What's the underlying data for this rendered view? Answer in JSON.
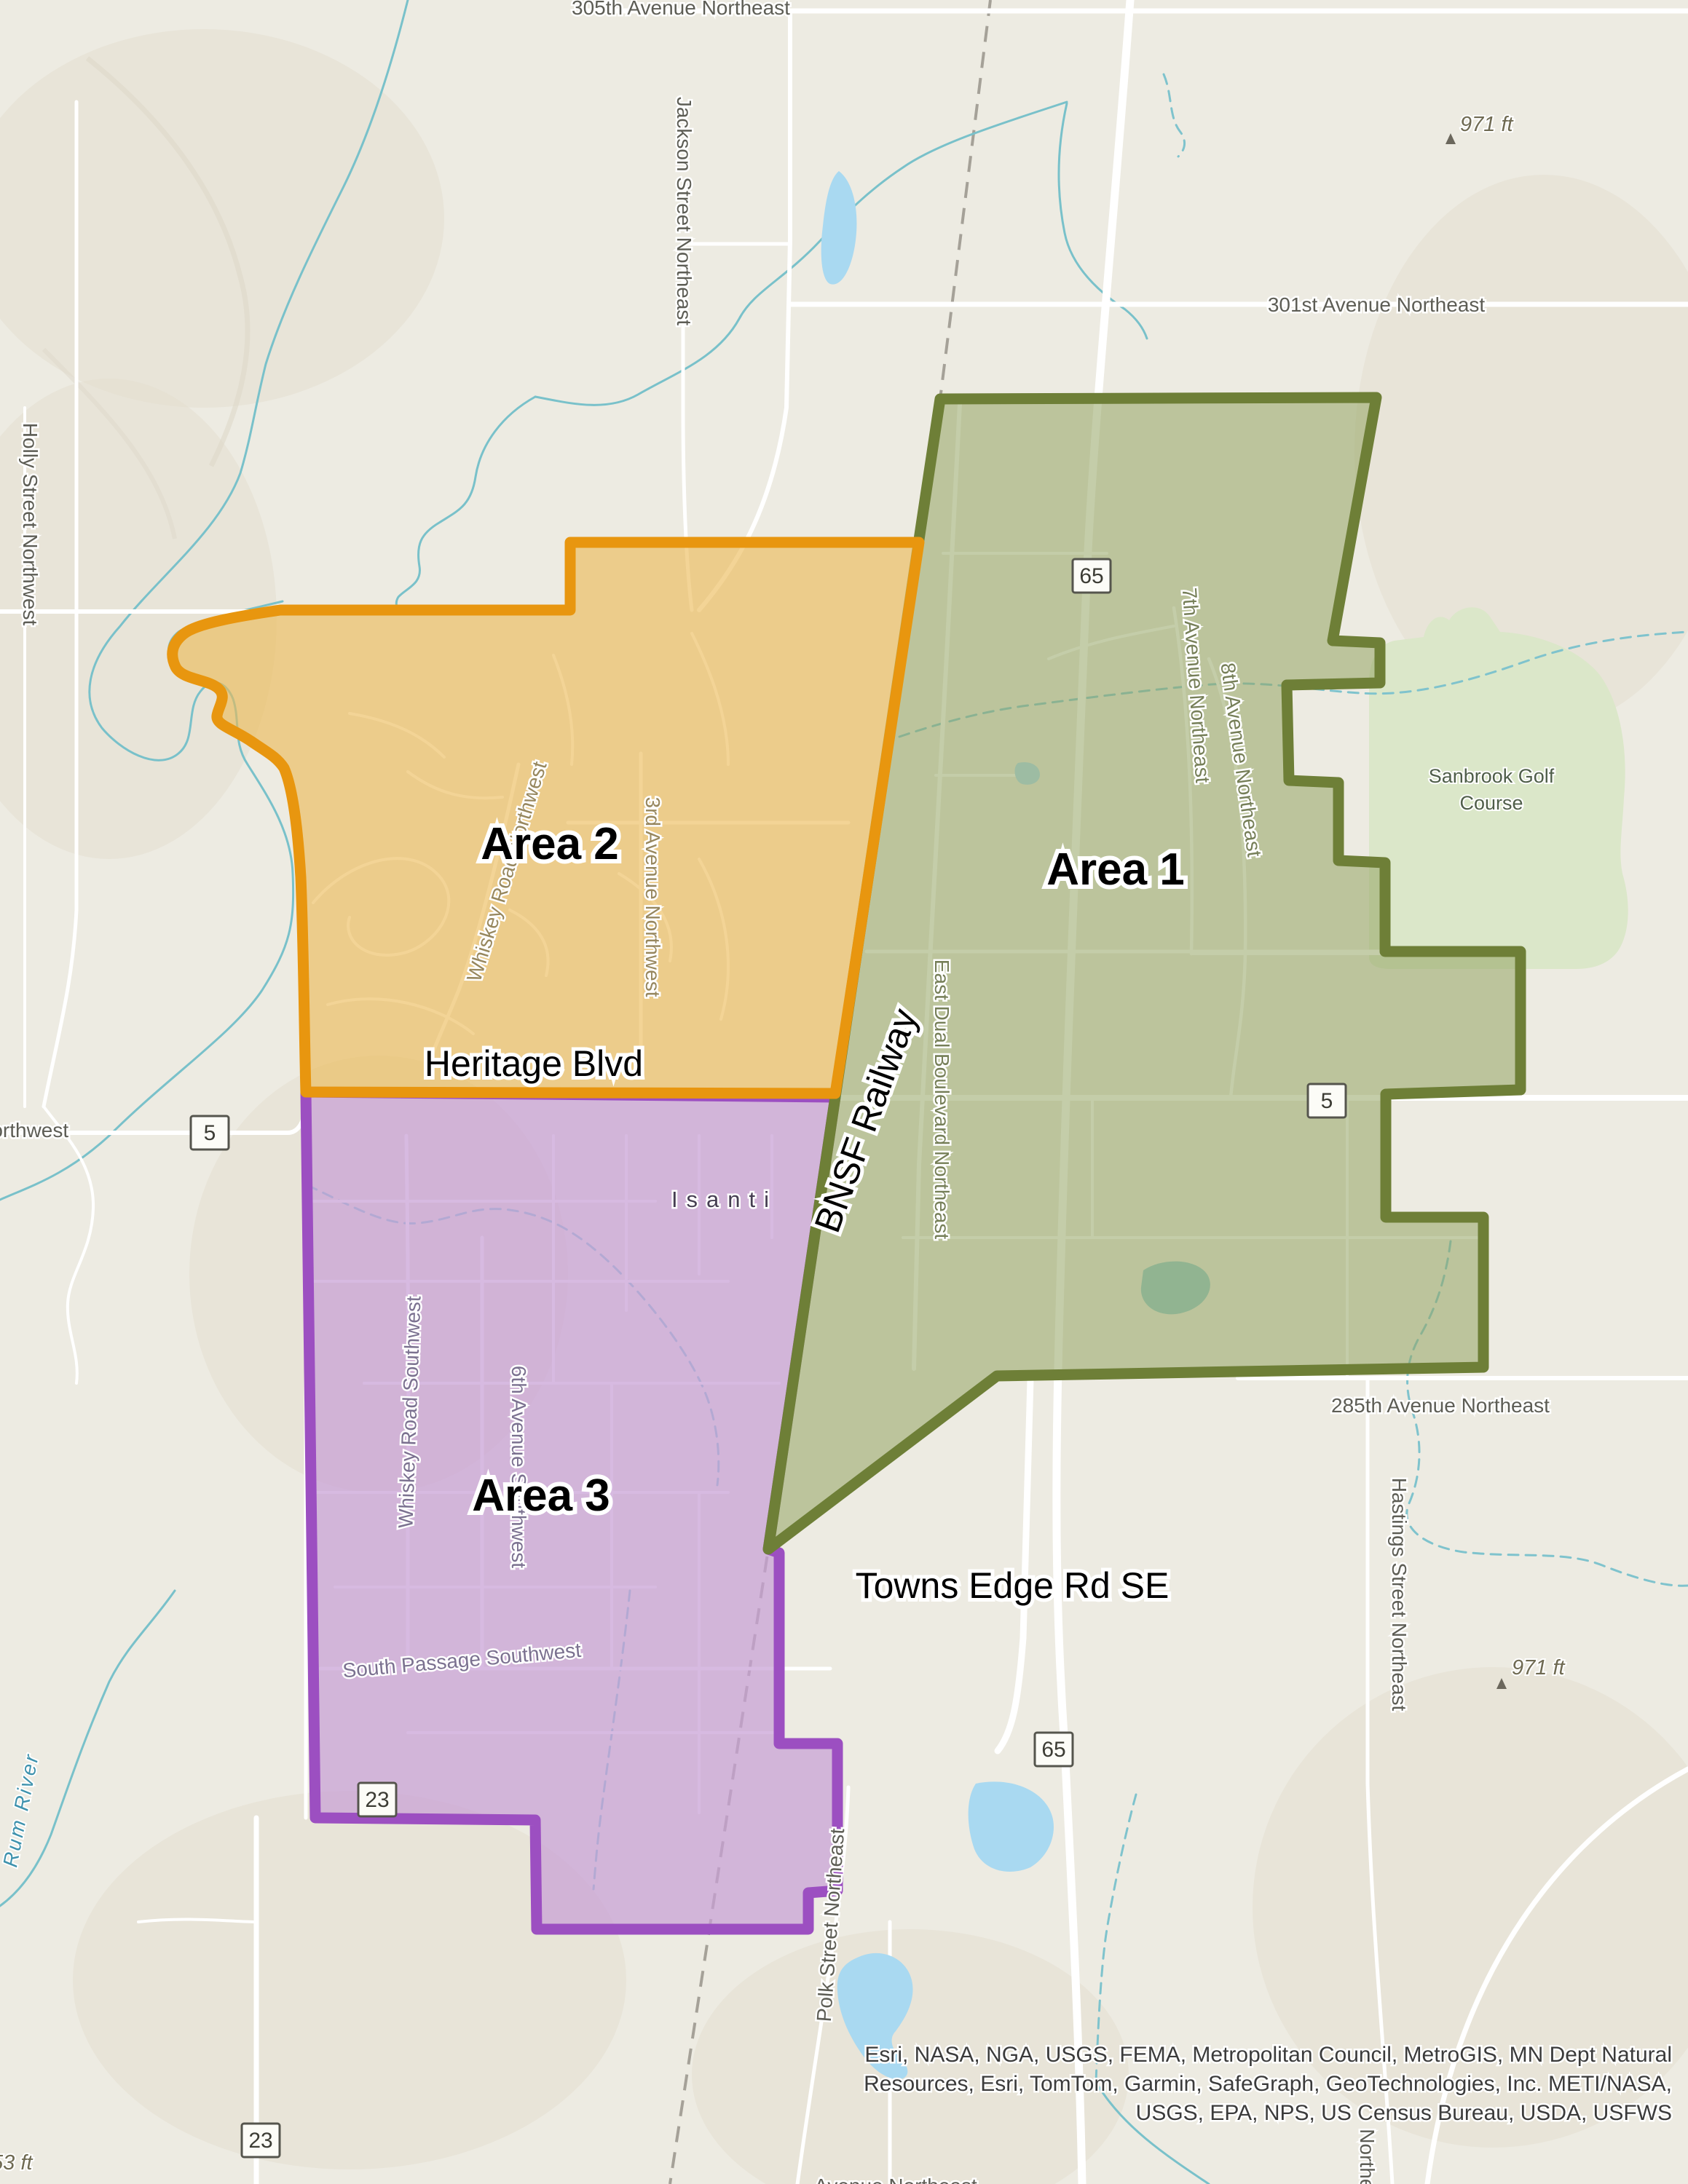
{
  "map": {
    "areas": {
      "area1": "Area 1",
      "area2": "Area 2",
      "area3": "Area 3"
    },
    "boundary_labels": {
      "heritage_blvd": "Heritage Blvd",
      "bnsf_railway": "BNSF Railway",
      "towns_edge": "Towns Edge Rd SE"
    },
    "city": {
      "name": "Isanti"
    },
    "streets": {
      "ave305": "305th Avenue Northeast",
      "ave301": "301st Avenue Northeast",
      "jackson": "Jackson Street Northeast",
      "holly": "Holly Street Northwest",
      "road5": "ad 5 Northwest",
      "whiskey_nw": "Whiskey Road Northwest",
      "ave3rd": "3rd Avenue Northwest",
      "east_dual": "East Dual Boulevard Northeast",
      "ave7": "7th Avenue Northeast",
      "ave8": "8th Avenue Northeast",
      "ave285": "285th Avenue Northeast",
      "hastings": "Hastings Street Northeast",
      "polk": "Polk Street Northeast",
      "whiskey_sw": "Whiskey Road Southwest",
      "ave6": "6th Avenue Southwest",
      "south_passage": "South Passage Southwest",
      "ave_partial": "Avenue Northeast",
      "northeast_partial": "Northeast"
    },
    "water": {
      "rum_river": "Rum River"
    },
    "poi": {
      "golf_line1": "Sanbrook Golf",
      "golf_line2": "Course"
    },
    "elevations": {
      "e971a": "971 ft",
      "e971b": "971 ft",
      "e53": "53 ft"
    },
    "shields": {
      "s65": "65",
      "s5": "5",
      "s23": "23"
    },
    "attribution": {
      "line1": "Esri, NASA, NGA, USGS, FEMA, Metropolitan Council, MetroGIS, MN Dept Natural",
      "line2": "Resources, Esri, TomTom, Garmin, SafeGraph, GeoTechnologies, Inc. METI/NASA,",
      "line3": "USGS, EPA, NPS, US Census Bureau, USDA, USFWS"
    },
    "colors": {
      "area1_stroke": "#6e7f37",
      "area1_fill": "#93a462",
      "area2_stroke": "#e8960f",
      "area2_fill": "#ecba55",
      "area3_stroke": "#9c4fc1",
      "area3_fill": "#c79fd6",
      "lake": "#a9d9f1",
      "golf": "#dbe7c9"
    }
  }
}
